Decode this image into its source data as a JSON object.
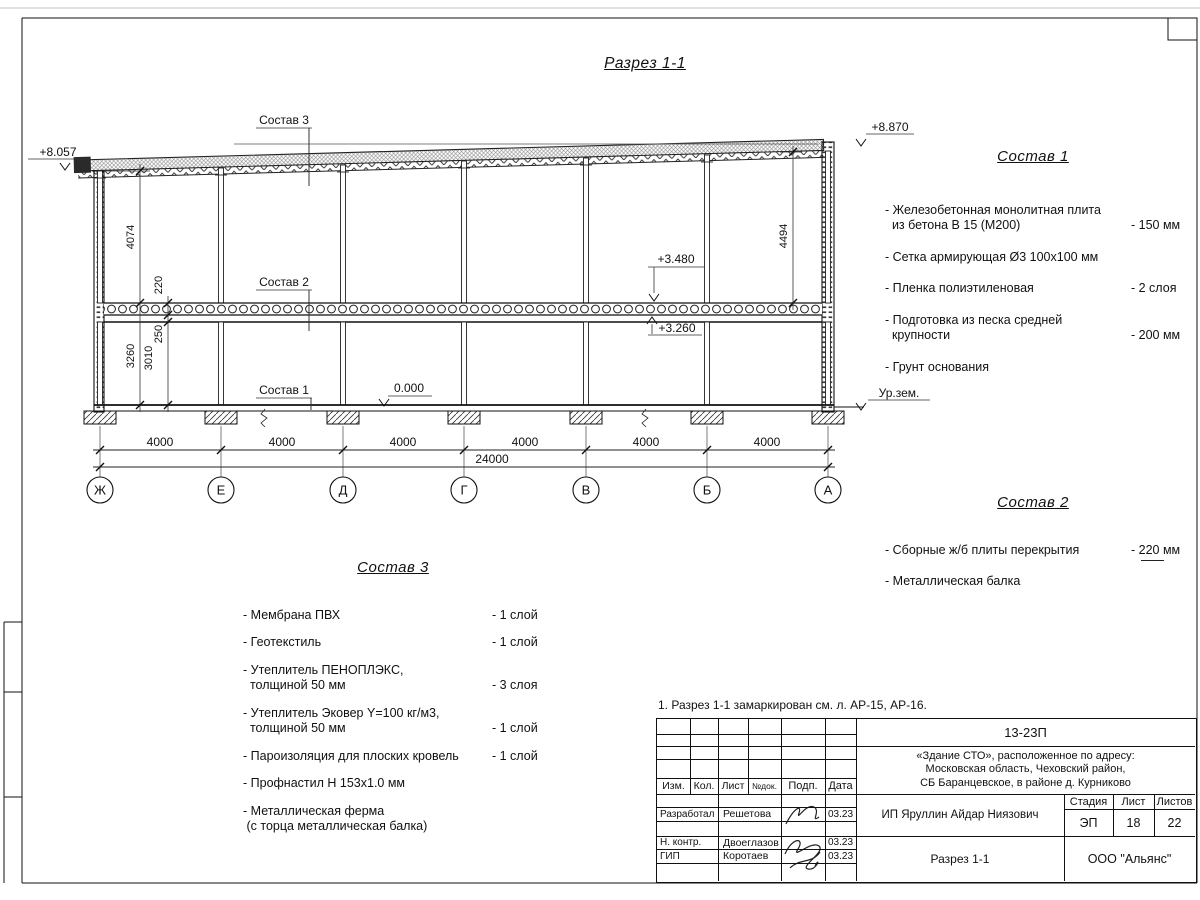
{
  "sheet": {
    "title": "Разрез 1-1",
    "note": "1. Разрез 1-1 замаркирован см. л. АР-15, АР-16."
  },
  "section": {
    "labels": {
      "s1": "Состав 1",
      "s2": "Состав 2",
      "s3": "Состав 3"
    },
    "elevations": {
      "roof_left": "+8.057",
      "roof_right": "+8.870",
      "slab_top": "+3.480",
      "slab_bottom": "+3.260",
      "floor": "0.000",
      "ground": "Ур.зем."
    },
    "dims": {
      "upper_left": "4074",
      "slab": "220",
      "beam_gap": "250",
      "lower_outer": "3260",
      "lower_inner": "3010",
      "upper_right": "4494",
      "total": "24000"
    },
    "bay_dims": [
      "4000",
      "4000",
      "4000",
      "4000",
      "4000",
      "4000"
    ],
    "axes": [
      "Ж",
      "Е",
      "Д",
      "Г",
      "В",
      "Б",
      "А"
    ]
  },
  "panels": {
    "sostav1": {
      "title": "Состав 1",
      "items": [
        {
          "text": "- Железобетонная  монолитная плита\n  из бетона В 15 (М200)",
          "value": "- 150 мм"
        },
        {
          "text": "- Сетка армирующая Ø3 100х100 мм",
          "value": ""
        },
        {
          "text": "- Пленка полиэтиленовая",
          "value": "-  2 слоя"
        },
        {
          "text": "- Подготовка из песка средней\n  крупности",
          "value": "- 200 мм"
        },
        {
          "text": "- Грунт основания",
          "value": ""
        }
      ]
    },
    "sostav2": {
      "title": "Состав 2",
      "items": [
        {
          "text": "- Сборные ж/б плиты перекрытия",
          "value": "- 220 мм"
        },
        {
          "text": "- Металлическая  балка",
          "value": ""
        }
      ]
    },
    "sostav3": {
      "title": "Состав 3",
      "items": [
        {
          "text": "- Мембрана ПВХ",
          "value": "- 1 слой"
        },
        {
          "text": "- Геотекстиль",
          "value": "- 1 слой"
        },
        {
          "text": "- Утеплитель ПЕНОПЛЭКС,\n  толщиной 50 мм",
          "value": "- 3 слоя"
        },
        {
          "text": "- Утеплитель Эковер Y=100 кг/м3,\n  толщиной 50 мм",
          "value": "- 1 слой"
        },
        {
          "text": "- Пароизоляция для плоских кровель",
          "value": "- 1 слой"
        },
        {
          "text": "- Профнастил Н 153х1.0 мм",
          "value": ""
        },
        {
          "text": "- Металлическая ферма\n (с торца металлическая балка)",
          "value": ""
        }
      ]
    }
  },
  "titleblock": {
    "code": "13-23П",
    "address_lines": [
      "«Здание СТО», расположенное по адресу:",
      "Московская область, Чеховский район,",
      "СБ Баранцевское, в районе д. Курниково"
    ],
    "columns": [
      "Изм.",
      "Кол.",
      "Лист",
      "№док.",
      "Подп.",
      "Дата"
    ],
    "staff": [
      {
        "role": "Разработал",
        "name": "Решетова",
        "date": "03.23"
      },
      {
        "role": "Н. контр.",
        "name": "Двоеглазов",
        "date": "03.23"
      },
      {
        "role": "ГИП",
        "name": "Коротаев",
        "date": "03.23"
      }
    ],
    "client": "ИП Яруллин Айдар Ниязович",
    "stage_label": "Стадия",
    "sheet_label": "Лист",
    "sheets_label": "Листов",
    "stage": "ЭП",
    "sheet_no": "18",
    "sheets_total": "22",
    "drawing_title": "Разрез 1-1",
    "company": "ООО \"Альянс\""
  }
}
